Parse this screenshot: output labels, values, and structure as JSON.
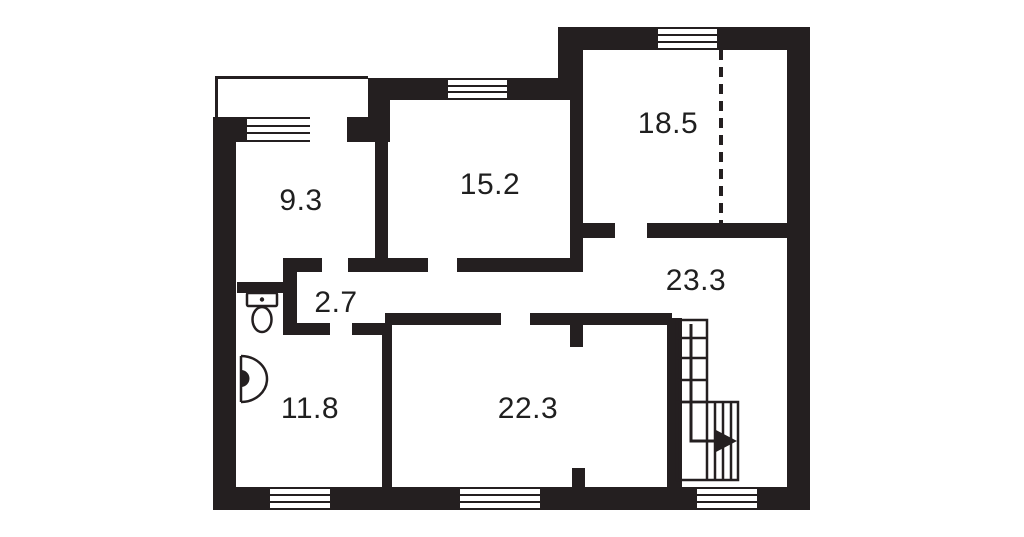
{
  "floor_plan": {
    "rooms": [
      {
        "name": "room-top-left",
        "area": "9.3"
      },
      {
        "name": "room-top-middle",
        "area": "15.2"
      },
      {
        "name": "room-top-right",
        "area": "18.5"
      },
      {
        "name": "hallway",
        "area": "23.3"
      },
      {
        "name": "wc-lobby",
        "area": "2.7"
      },
      {
        "name": "room-bottom-left",
        "area": "11.8"
      },
      {
        "name": "room-bottom-middle",
        "area": "22.3"
      }
    ],
    "fixtures": [
      {
        "type": "toilet-icon",
        "location": "wc near left wall"
      },
      {
        "type": "sink-icon",
        "location": "left wall of bottom-left room"
      },
      {
        "type": "staircase-icon",
        "location": "bottom-right, L-shaped with direction arrow"
      },
      {
        "type": "direction-arrow-icon",
        "location": "end of stair walk line, pointing right"
      },
      {
        "type": "dashed-partition-line",
        "location": "vertical, inside top-right room"
      },
      {
        "type": "balcony-outline",
        "location": "top-left, thin line rectangle"
      }
    ],
    "window_count": 6,
    "colors": {
      "wall": "#241f20",
      "background": "#ffffff",
      "label": "#1f1f1f"
    }
  }
}
